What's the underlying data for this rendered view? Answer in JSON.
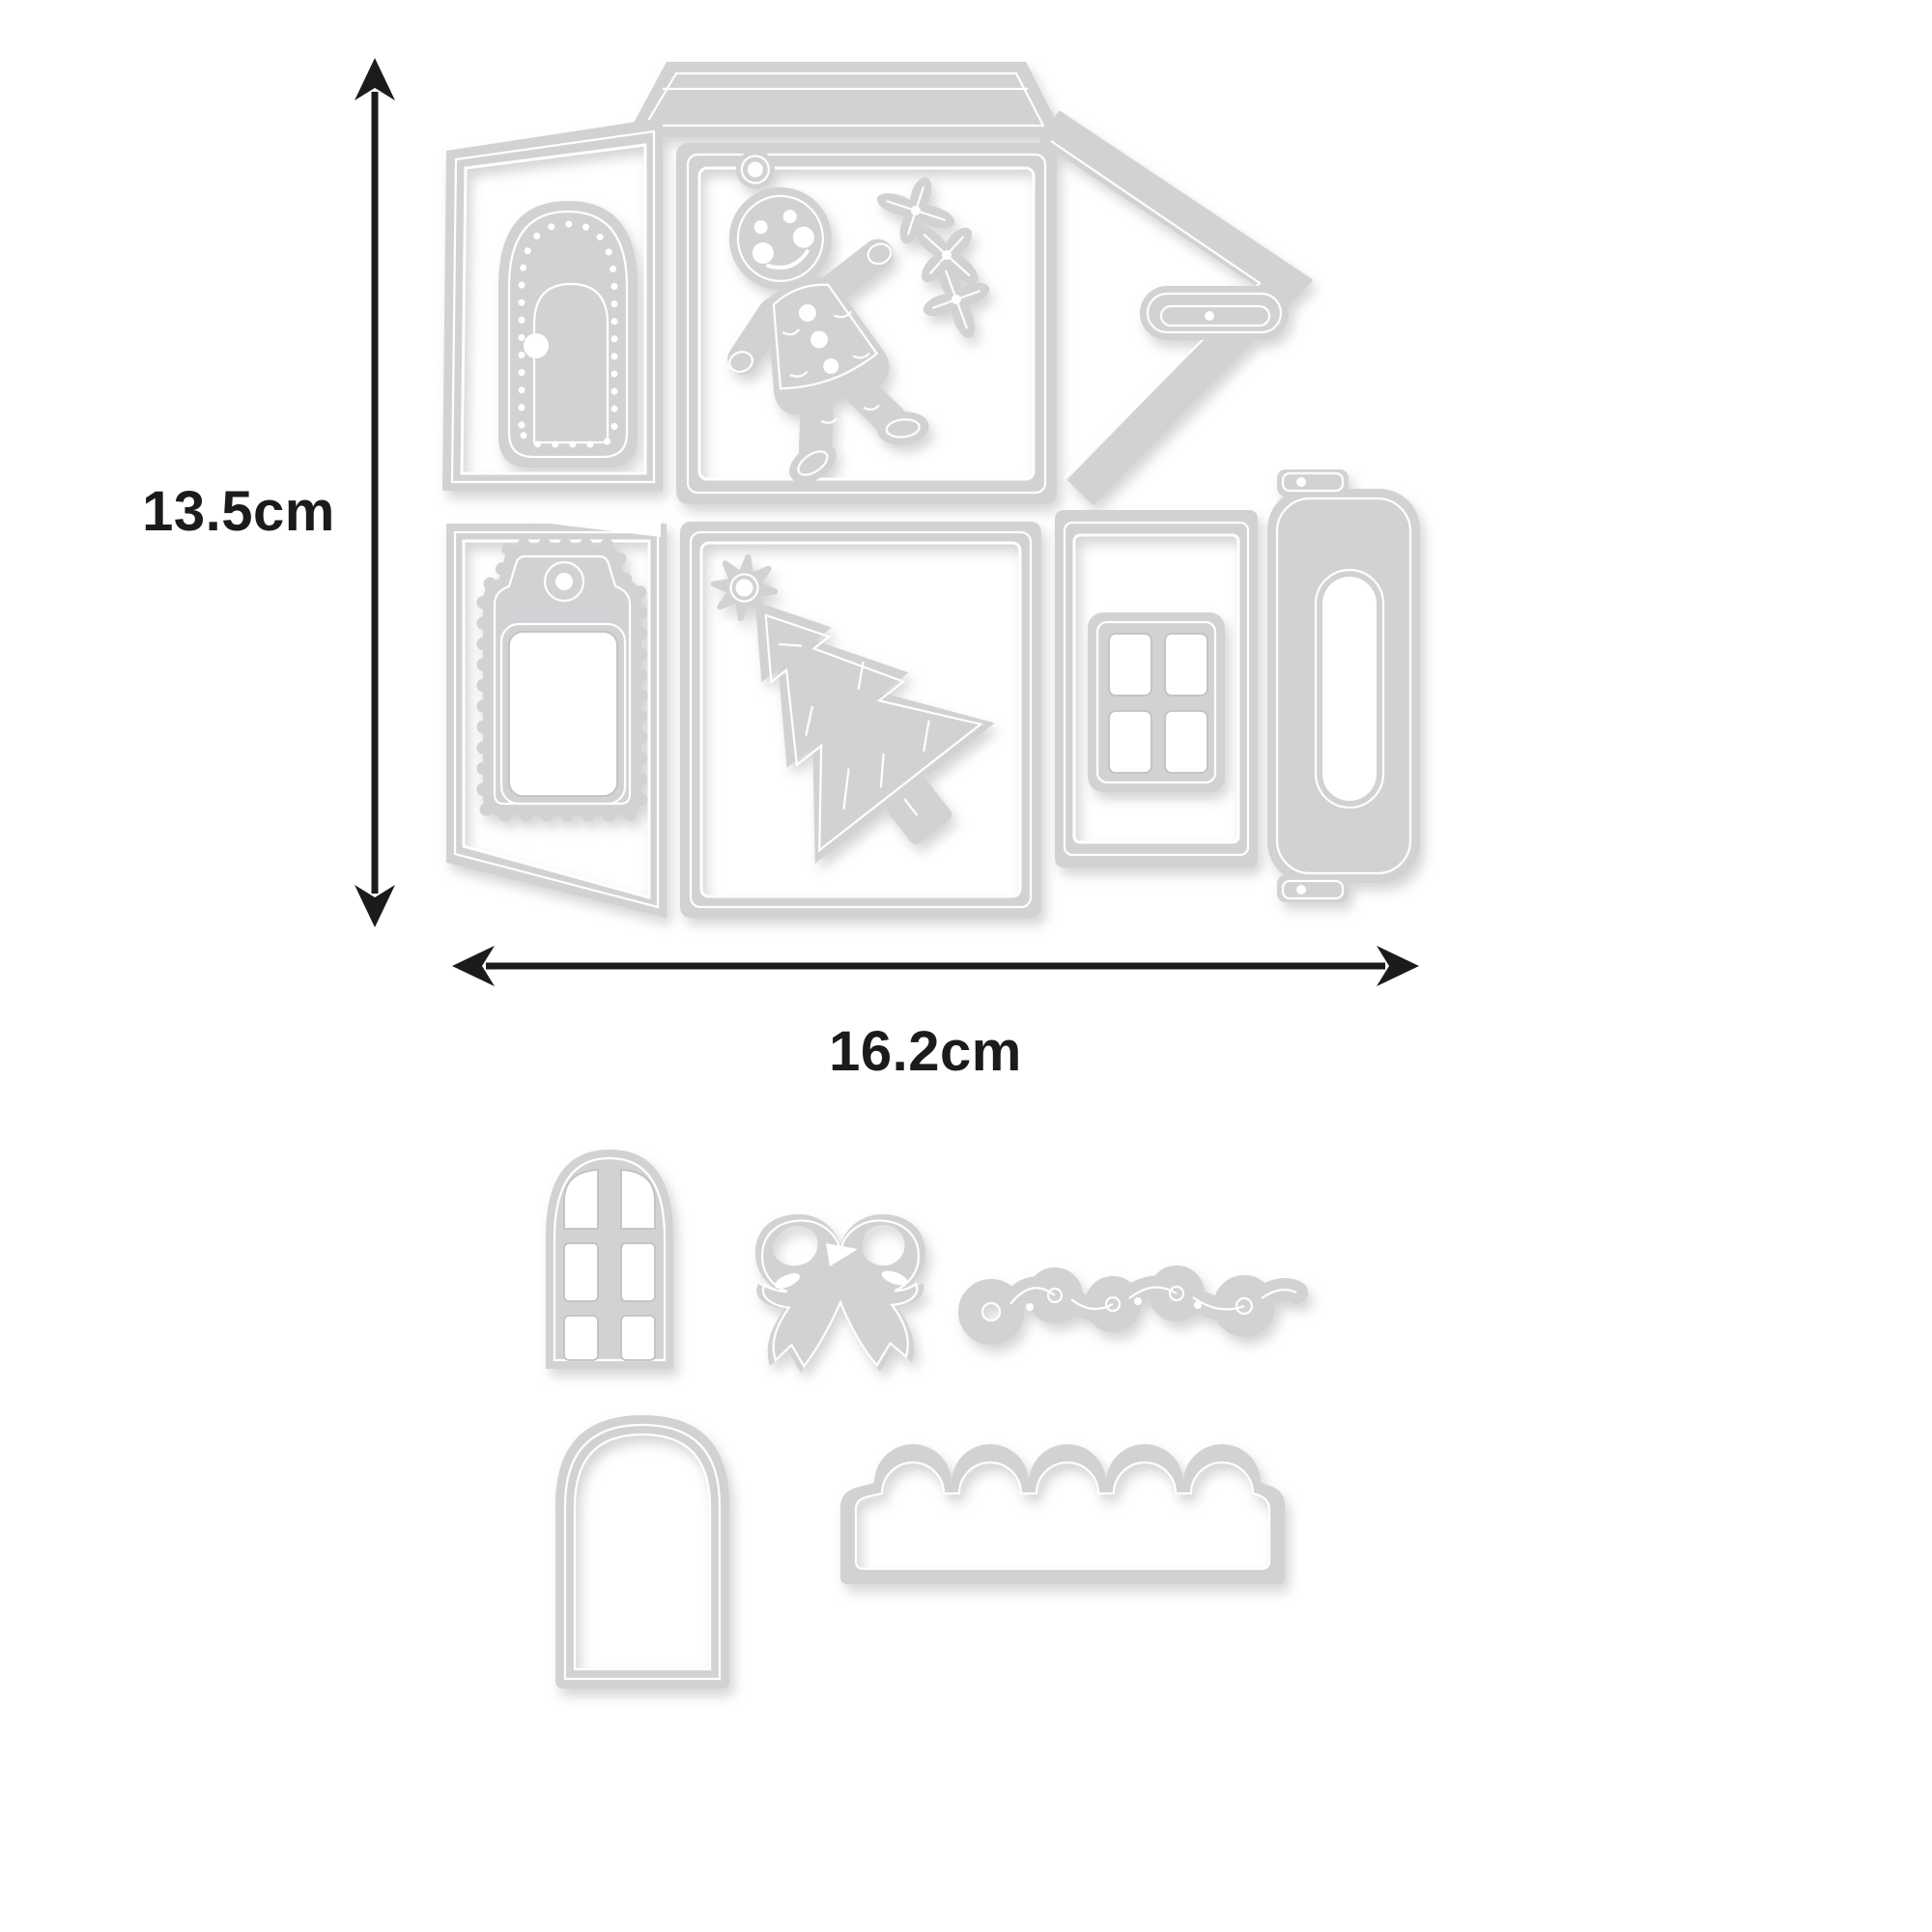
{
  "annotations": {
    "height_label": "13.5cm",
    "width_label": "16.2cm"
  },
  "colors": {
    "background": "#ffffff",
    "metal": "#d3d1d4",
    "metal_highlight": "#ffffff",
    "metal_shadow": "#c2c0c3",
    "dimension": "#1b1b1b"
  },
  "parts": {
    "main_die": "christmas-house-gift-box-die-plate",
    "lid_flap": "lid-flap",
    "door_panel": "side-panel-with-arched-door",
    "arched_door": "dotted-arched-door-die",
    "front_panel": "front-panel",
    "gingerbread_man": "gingerbread-man-die",
    "holly_sprig": "holly-sprig-die",
    "closure_flap": "pointed-closure-flap",
    "slot_tab": "slot-tab",
    "tag_panel": "tag-panel",
    "tag": "scalloped-tag-die",
    "tree_panel": "tree-panel",
    "tree": "christmas-tree-die",
    "window_panel": "window-panel",
    "window": "four-pane-window-die",
    "handle": "carry-handle-die",
    "arched_window": "arched-window-die",
    "bow": "bow-die",
    "scroll": "scroll-flourish-die",
    "arch_frame": "arch-frame-die",
    "scallop_border": "scalloped-border-die"
  }
}
